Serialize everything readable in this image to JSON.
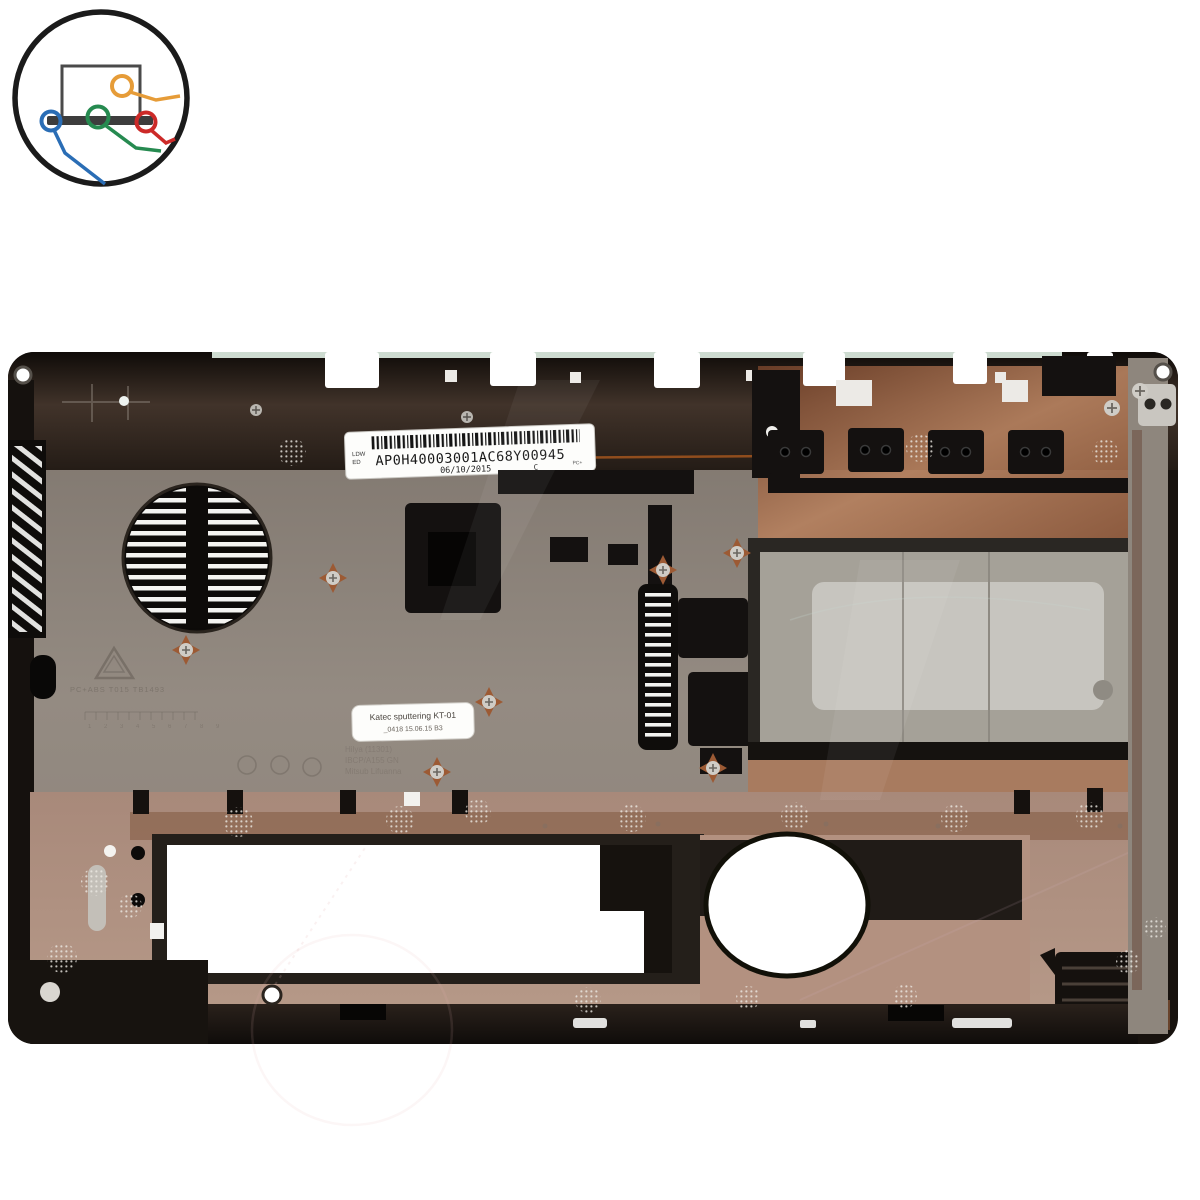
{
  "page": {
    "background": "#ffffff",
    "description": "product photo of a laptop bottom base cover on white background"
  },
  "logo": {
    "name": "notebook-parts-store-logo",
    "colors": {
      "ring": "#1b1b1b",
      "laptop": "#3d3d3d",
      "cable_orange": "#e69c38",
      "cable_blue": "#2a6db5",
      "cable_green": "#268a50",
      "cable_red": "#cc2a28"
    }
  },
  "part": {
    "name": "laptop bottom case",
    "colors": {
      "rim_dark": "#17120e",
      "top_band_dark": "#221a14",
      "panel_gray": "#8d847b",
      "copper": "#9c6644",
      "copper_light": "#b3907c",
      "hdd_floor": "#a5a198",
      "emi_sticker": "#c7c5bf",
      "mint_rim": "#d8e7db",
      "vent_black": "#0d0b09",
      "slat_white": "#f4f4f1",
      "label_white": "#fdfdfb"
    },
    "barcode_label": {
      "code": "AP0H40003001AC68Y00945",
      "date": "06/10/2015",
      "rev": "C",
      "prefix_top": "LDW",
      "prefix_bottom": "ED",
      "corner_mark": "PC+"
    },
    "process_label": {
      "line1": "Katec sputtering KT-01",
      "line2": "_0418   15.06.15   B3"
    },
    "molded": {
      "material": "PC+ABS T015 TB1493",
      "line1": "Hilya (11301)",
      "line2": "IBCP/A155 GN",
      "line3": "Mitsub Lifuanna",
      "ruler": "1 2 3 4 5 6 7 8 9"
    }
  }
}
